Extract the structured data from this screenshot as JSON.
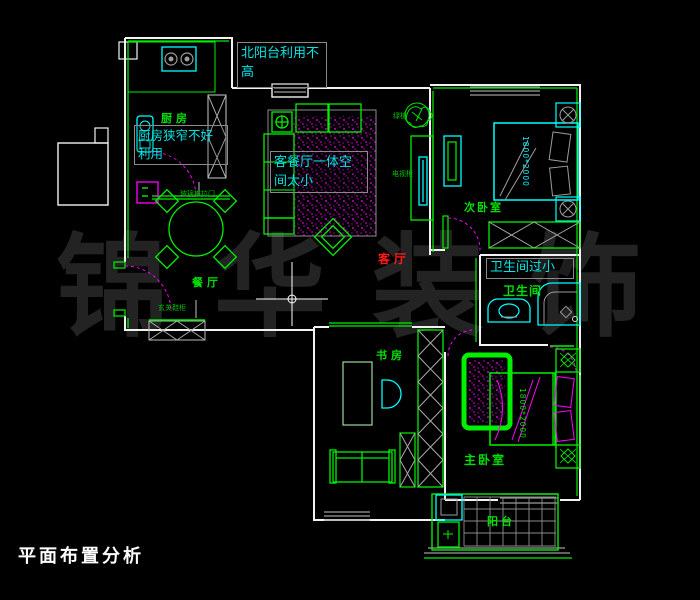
{
  "watermark": {
    "text": "锦华装饰"
  },
  "footer": {
    "title": "平面布置分析"
  },
  "notes": {
    "north_balcony": "北阳台利用不高",
    "kitchen": "厨房狭窄不好利用",
    "living": "客餐厅一体空间太小",
    "bathroom": "卫生间过小"
  },
  "rooms": {
    "kitchen": "厨房",
    "dining": "餐厅",
    "living": "客厅",
    "secondary_bedroom": "次卧室",
    "bathroom": "卫生间",
    "study": "书房",
    "master_bedroom": "主卧室",
    "balcony": "阳台"
  },
  "furniture_labels": {
    "kitchen_door": "玻璃推拉门",
    "entry_cabinet": "玄关鞋柜",
    "plant": "绿植",
    "tv_cabinet": "电视柜"
  },
  "dimensions": {
    "secondary_bed": "1800*2000",
    "master_bed": "1800*2000"
  },
  "colors": {
    "background": "#000000",
    "wall": "#f2f2f2",
    "structure_green": "#00f000",
    "fixture_cyan": "#00ffff",
    "hatch_magenta": "#ff00ff",
    "label_green": "#00e000",
    "label_red": "#ff1a1a",
    "window_gray": "#9c9c9c",
    "note_text": "#00e5e5",
    "note_border": "#8a8a8a",
    "watermark": "#232323",
    "footer_text": "#ffffff"
  }
}
